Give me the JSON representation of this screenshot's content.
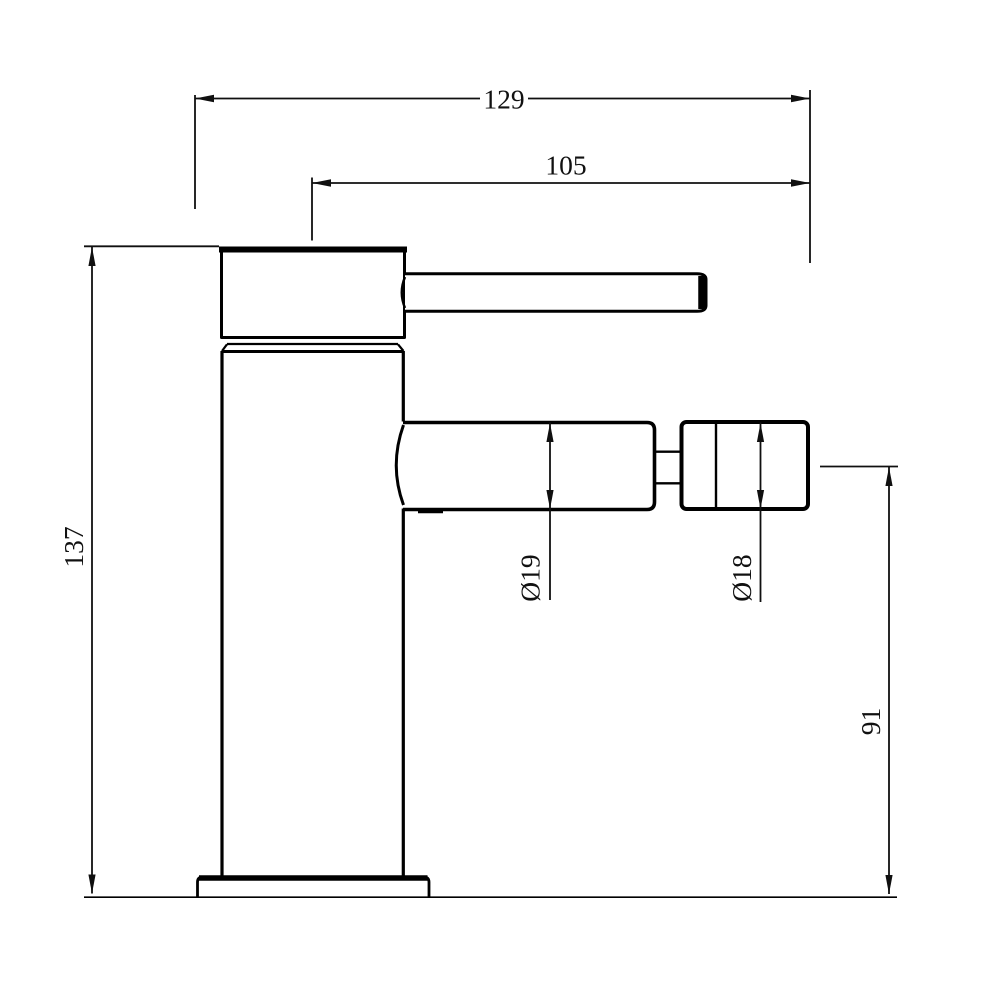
{
  "drawing": {
    "kind": "bidet-mixer-tap-side-elevation",
    "dimensions": {
      "total_length": "129",
      "spout_reach": "105",
      "overall_height": "137",
      "outlet_center_height": "91",
      "spout_diameter": "Ø19",
      "nozzle_diameter": "Ø18"
    },
    "colors": {
      "line": "#000000",
      "background": "#ffffff"
    }
  }
}
